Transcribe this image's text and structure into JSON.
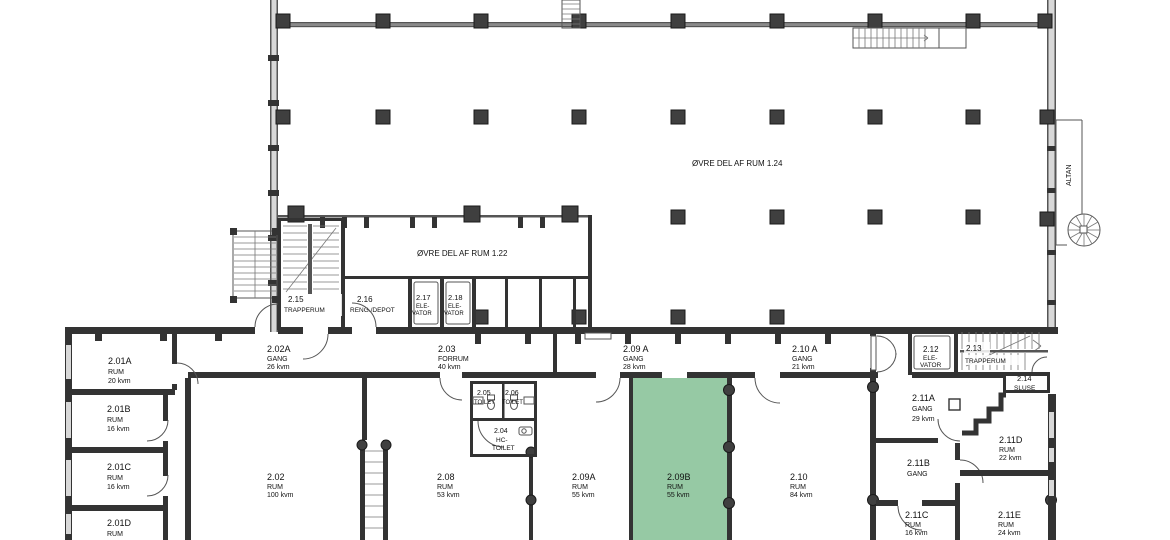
{
  "plan": {
    "highlight_color": "#96c9a4",
    "overlays": {
      "upper_room_1_24": "ØVRE DEL AF RUM 1.24",
      "upper_room_1_22": "ØVRE DEL AF RUM 1.22",
      "balcony": "ALTAN"
    },
    "rooms": [
      {
        "lines": [
          "2.01A",
          "RUM",
          "20 kvm"
        ]
      },
      {
        "lines": [
          "2.01B",
          "RUM",
          "16 kvm"
        ]
      },
      {
        "lines": [
          "2.01C",
          "RUM",
          "16 kvm"
        ]
      },
      {
        "lines": [
          "2.01D",
          "RUM",
          "20 kvm"
        ]
      },
      {
        "lines": [
          "2.02A",
          "GANG",
          "26 kvm"
        ]
      },
      {
        "lines": [
          "2.02",
          "RUM",
          "100 kvm"
        ]
      },
      {
        "lines": [
          "2.03",
          "FORRUM",
          "40 kvm"
        ]
      },
      {
        "lines": [
          "2.04",
          "HC-",
          "TOILET"
        ]
      },
      {
        "lines": [
          "2.05",
          "TOILET"
        ]
      },
      {
        "lines": [
          "2.06",
          "TOILET"
        ]
      },
      {
        "lines": [
          "2.08",
          "RUM",
          "53 kvm"
        ]
      },
      {
        "lines": [
          "2.09 A",
          "GANG",
          "28 kvm"
        ]
      },
      {
        "lines": [
          "2.09A",
          "RUM",
          "55 kvm"
        ]
      },
      {
        "lines": [
          "2.09B",
          "RUM",
          "55 kvm"
        ],
        "highlighted": true
      },
      {
        "lines": [
          "2.10 A",
          "GANG",
          "21 kvm"
        ]
      },
      {
        "lines": [
          "2.10",
          "RUM",
          "84 kvm"
        ]
      },
      {
        "lines": [
          "2.11A",
          "GANG",
          "29 kvm"
        ]
      },
      {
        "lines": [
          "2.11B",
          "GANG"
        ]
      },
      {
        "lines": [
          "2.11C",
          "RUM",
          "16 kvm"
        ]
      },
      {
        "lines": [
          "2.11D",
          "RUM",
          "22 kvm"
        ]
      },
      {
        "lines": [
          "2.11E",
          "RUM",
          "24 kvm"
        ]
      },
      {
        "lines": [
          "2.12",
          "ELE-",
          "VATOR"
        ]
      },
      {
        "lines": [
          "2.13",
          "TRAPPERUM"
        ]
      },
      {
        "lines": [
          "2.14",
          "SLUSE"
        ]
      },
      {
        "lines": [
          "2.15",
          "TRAPPERUM"
        ]
      },
      {
        "lines": [
          "2.16",
          "RENG./DEPOT"
        ]
      },
      {
        "lines": [
          "2.17",
          "ELE-",
          "VATOR"
        ]
      },
      {
        "lines": [
          "2.18",
          "ELE-",
          "VATOR"
        ]
      }
    ]
  }
}
